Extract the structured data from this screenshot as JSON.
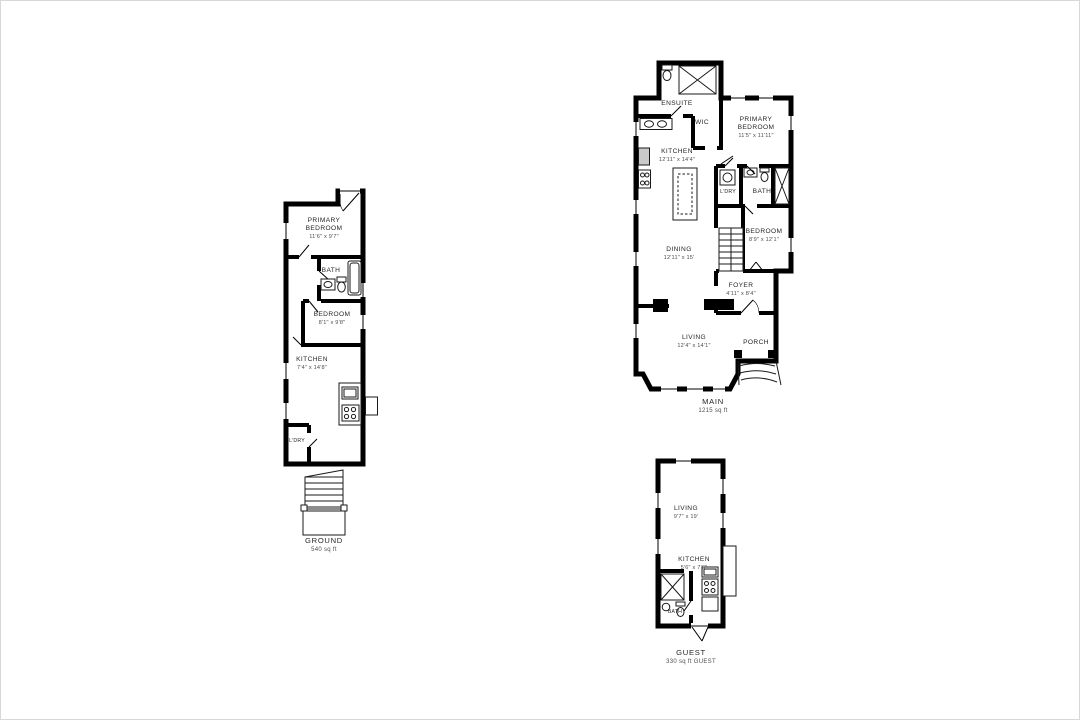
{
  "sheet": {
    "title": "Floor plans",
    "background": "#ffffff",
    "wall_color": "#000000",
    "text_color": "#262626"
  },
  "plans": {
    "ground": {
      "name": "GROUND",
      "area": "540 sq ft",
      "rooms": {
        "primary_bedroom": {
          "label": "PRIMARY BEDROOM",
          "dims": "11'6\" x 9'7\""
        },
        "bath": {
          "label": "BATH"
        },
        "bedroom": {
          "label": "BEDROOM",
          "dims": "8'1\" x 9'8\""
        },
        "kitchen": {
          "label": "KITCHEN",
          "dims": "7'4\" x 14'8\""
        },
        "laundry": {
          "label": "L'DRY"
        }
      }
    },
    "main": {
      "name": "MAIN",
      "area": "1215 sq ft",
      "rooms": {
        "ensuite": {
          "label": "ENSUITE"
        },
        "wic": {
          "label": "WIC"
        },
        "primary_bedroom": {
          "label": "PRIMARY BEDROOM",
          "dims": "11'5\" x 11'11\""
        },
        "kitchen": {
          "label": "KITCHEN",
          "dims": "12'11\" x 14'4\""
        },
        "laundry": {
          "label": "L'DRY"
        },
        "bath": {
          "label": "BATH"
        },
        "bedroom": {
          "label": "BEDROOM",
          "dims": "8'9\" x 12'1\""
        },
        "dining": {
          "label": "DINING",
          "dims": "12'11\" x 15'"
        },
        "foyer": {
          "label": "FOYER",
          "dims": "4'11\" x 8'4\""
        },
        "living": {
          "label": "LIVING",
          "dims": "12'4\" x 14'1\""
        },
        "porch": {
          "label": "PORCH"
        }
      }
    },
    "guest": {
      "name": "GUEST",
      "area": "330 sq ft GUEST",
      "rooms": {
        "living": {
          "label": "LIVING",
          "dims": "9'7\" x 19'"
        },
        "kitchen": {
          "label": "KITCHEN",
          "dims": "5'6\" x 7'6\""
        },
        "bath": {
          "label": "BATH"
        }
      }
    }
  }
}
